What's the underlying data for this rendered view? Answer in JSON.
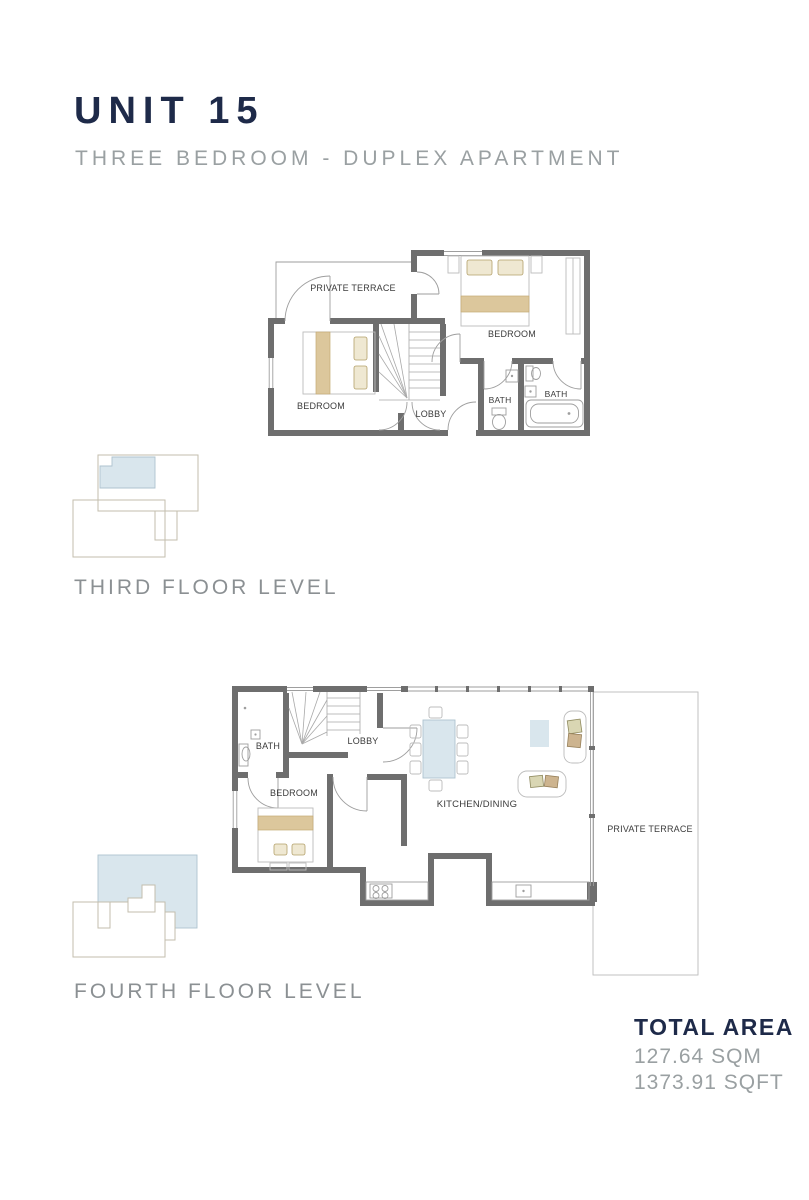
{
  "header": {
    "title": "UNIT 15",
    "subtitle": "THREE BEDROOM - DUPLEX APARTMENT"
  },
  "floors": {
    "third": {
      "label": "THIRD FLOOR LEVEL",
      "rooms": {
        "terrace": "PRIVATE TERRACE",
        "bedroom_right": "BEDROOM",
        "bedroom_left": "BEDROOM",
        "lobby": "LOBBY",
        "bath_small": "BATH",
        "bath_large": "BATH"
      }
    },
    "fourth": {
      "label": "FOURTH FLOOR LEVEL",
      "rooms": {
        "bath": "BATH",
        "lobby": "LOBBY",
        "bedroom": "BEDROOM",
        "kitchen_dining": "KITCHEN/DINING",
        "terrace": "PRIVATE TERRACE"
      }
    }
  },
  "total_area": {
    "heading": "TOTAL AREA",
    "sqm": "127.64 SQM",
    "sqft": "1373.91 SQFT"
  },
  "colors": {
    "navy": "#1e2a49",
    "subtitle_gray": "#9aa0a2",
    "wall_gray": "#6e6e6e",
    "furniture_tan": "#dcc79c",
    "highlight_blue": "#d9e6ed"
  }
}
